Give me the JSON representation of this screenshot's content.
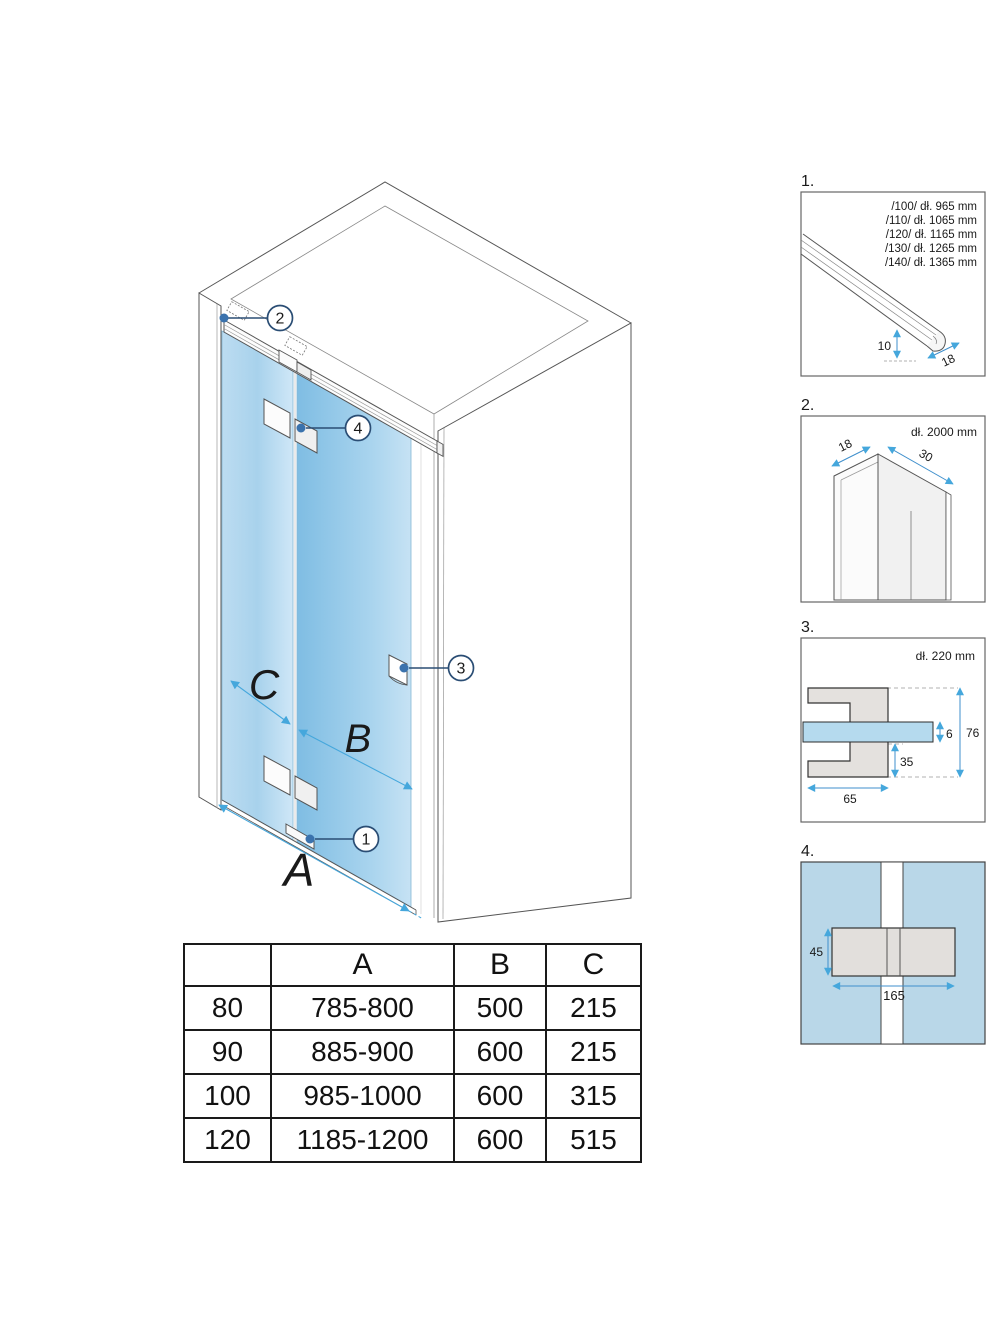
{
  "main": {
    "dim_a": "A",
    "dim_b": "B",
    "dim_c": "C",
    "callout_1": "1",
    "callout_2": "2",
    "callout_3": "3",
    "callout_4": "4"
  },
  "panels": {
    "p1": {
      "label": "1.",
      "lines": [
        "/100/ dł. 965 mm",
        "/110/ dł. 1065 mm",
        "/120/ dł. 1165 mm",
        "/130/ dł. 1265 mm",
        "/140/ dł. 1365 mm"
      ],
      "dim_height": "10",
      "dim_width": "18"
    },
    "p2": {
      "label": "2.",
      "length_note": "dł. 2000 mm",
      "dim_width": "18",
      "dim_depth": "30"
    },
    "p3": {
      "label": "3.",
      "length_note": "dł. 220 mm",
      "dim_glass_thickness": "6",
      "dim_total_height": "76",
      "dim_lower_height": "35",
      "dim_width": "65"
    },
    "p4": {
      "label": "4.",
      "dim_height": "45",
      "dim_width": "165"
    }
  },
  "table": {
    "headers": [
      "",
      "A",
      "B",
      "C"
    ],
    "rows": [
      [
        "80",
        "785-800",
        "500",
        "215"
      ],
      [
        "90",
        "885-900",
        "600",
        "215"
      ],
      [
        "100",
        "985-1000",
        "600",
        "315"
      ],
      [
        "120",
        "1185-1200",
        "600",
        "515"
      ]
    ]
  },
  "colors": {
    "accent_arrow_blue": "#45a7dc",
    "leader_navy": "#2a4d74",
    "anchor_dot_blue": "#3a72ad",
    "glass_light": "#c6e2f4",
    "glass_dark": "#7fbde3",
    "panel4_background": "#b9d7e8",
    "bracket_gray": "#e4e1de",
    "line_gray": "#555555"
  }
}
